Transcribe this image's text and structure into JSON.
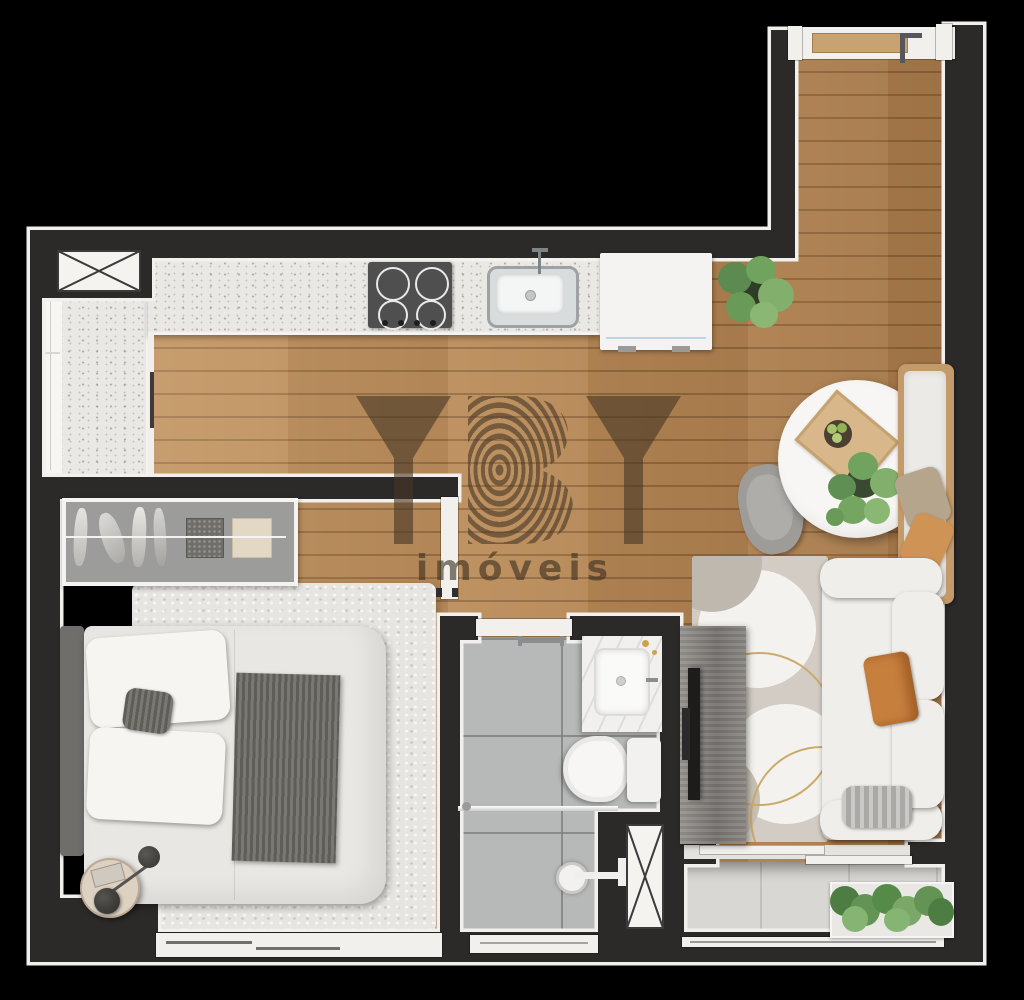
{
  "watermark": {
    "logo": "YBY",
    "subtitle": "imóveis"
  },
  "theme": {
    "colors": {
      "bg": "#000000",
      "wall": "#2b2a29",
      "lining": "#f2f0ec",
      "wood": "#b98a57",
      "counter": "#eae8e4",
      "cabinet": "#f7f6f3",
      "tile": "#b7b9b8",
      "balcony-tile": "#d8d7d4",
      "rug-bedroom": "#e7e5e1",
      "rug-living": "#d2ccc4",
      "sofa": "#f0eeea",
      "pillow-orange": "#c77f3e",
      "plant": "#5f8f52",
      "steel": "#9ea2a4",
      "cooktop": "#4f4f4f",
      "watermark": "#463726"
    }
  }
}
